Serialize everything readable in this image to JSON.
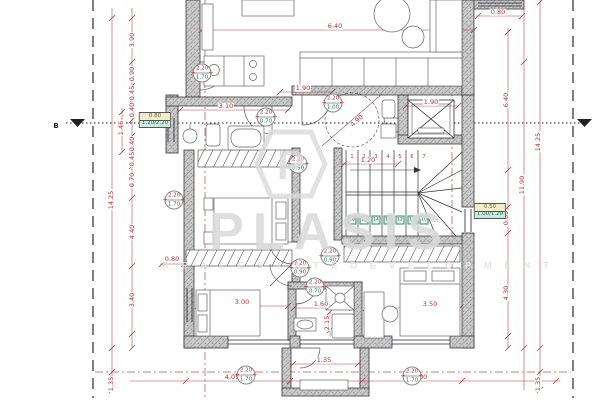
{
  "watermark": {
    "logo_letter": "P",
    "name": "PLASIS",
    "tagline": "R E A L   E S T A T E   D E V E L O P M E N T"
  },
  "section_mark": {
    "label": "B"
  },
  "colors": {
    "dimension_red": "#b03535",
    "axis_red": "#c04040",
    "wall_dark": "#3a3a3a",
    "tag_teal": "#1c7a5a",
    "tag_red": "#a33a3a",
    "watermark_gray": "#dadada"
  },
  "dimensions": [
    {
      "text": "3.90",
      "x": 132,
      "y": 40,
      "rot": -90
    },
    {
      "text": "0.90",
      "x": 132,
      "y": 74,
      "rot": -90
    },
    {
      "text": "0.45",
      "x": 132,
      "y": 93,
      "rot": -90
    },
    {
      "text": "0.40",
      "x": 132,
      "y": 110,
      "rot": -90
    },
    {
      "text": "1.46",
      "x": 121,
      "y": 128,
      "rot": -90
    },
    {
      "text": "0.40",
      "x": 132,
      "y": 144,
      "rot": -90
    },
    {
      "text": "0.45",
      "x": 132,
      "y": 159,
      "rot": -90
    },
    {
      "text": "0.70",
      "x": 132,
      "y": 180,
      "rot": -90
    },
    {
      "text": "4.40",
      "x": 132,
      "y": 232,
      "rot": -90
    },
    {
      "text": "3.40",
      "x": 132,
      "y": 300,
      "rot": -90
    },
    {
      "text": "14.25",
      "x": 111,
      "y": 200,
      "rot": -90
    },
    {
      "text": "1.35",
      "x": 111,
      "y": 384,
      "rot": -90
    },
    {
      "text": "6.40",
      "x": 335,
      "y": 26,
      "rot": 0
    },
    {
      "text": "0.80",
      "x": 498,
      "y": 12,
      "rot": 0
    },
    {
      "text": "6.40",
      "x": 506,
      "y": 100,
      "rot": -90
    },
    {
      "text": "0.80",
      "x": 506,
      "y": 218,
      "rot": -90
    },
    {
      "text": "4.30",
      "x": 506,
      "y": 293,
      "rot": -90
    },
    {
      "text": "11.90",
      "x": 522,
      "y": 185,
      "rot": -90
    },
    {
      "text": "14.25",
      "x": 538,
      "y": 142,
      "rot": -90
    },
    {
      "text": "1.35",
      "x": 538,
      "y": 384,
      "rot": -90
    },
    {
      "text": "3.10",
      "x": 226,
      "y": 106,
      "rot": 0
    },
    {
      "text": "1.90",
      "x": 303,
      "y": 88,
      "rot": 0
    },
    {
      "text": "1.90",
      "x": 431,
      "y": 102,
      "rot": 0
    },
    {
      "text": "4.90",
      "x": 357,
      "y": 121,
      "rot": -42
    },
    {
      "text": "1.20",
      "x": 368,
      "y": 160,
      "rot": 0
    },
    {
      "text": "0.80",
      "x": 172,
      "y": 259,
      "rot": 0
    },
    {
      "text": "3.00",
      "x": 242,
      "y": 302,
      "rot": 0
    },
    {
      "text": "1.60",
      "x": 321,
      "y": 304,
      "rot": 0
    },
    {
      "text": "3.50",
      "x": 430,
      "y": 304,
      "rot": 0
    },
    {
      "text": "2.15",
      "x": 327,
      "y": 323,
      "rot": -90
    },
    {
      "text": "1.35",
      "x": 324,
      "y": 360,
      "rot": 0
    },
    {
      "text": "4.05",
      "x": 232,
      "y": 377,
      "rot": 0
    },
    {
      "text": "5.00",
      "x": 420,
      "y": 377,
      "rot": 0
    }
  ],
  "door_tags": [
    {
      "x": 202,
      "y": 73,
      "top": "2.20",
      "bottom": "1.70"
    },
    {
      "x": 266,
      "y": 117,
      "top": "2.20",
      "bottom": "0.70"
    },
    {
      "x": 333,
      "y": 103,
      "top": "2.20",
      "bottom": "1.00"
    },
    {
      "x": 298,
      "y": 164,
      "top": "2.20",
      "bottom": "0.90"
    },
    {
      "x": 174,
      "y": 200,
      "top": "2.20",
      "bottom": "1.70"
    },
    {
      "x": 330,
      "y": 256,
      "top": "2.20",
      "bottom": "0.90"
    },
    {
      "x": 300,
      "y": 268,
      "top": "2.20",
      "bottom": "0.90"
    },
    {
      "x": 315,
      "y": 287,
      "top": "2.20",
      "bottom": "0.70"
    },
    {
      "x": 246,
      "y": 375,
      "top": "2.20",
      "bottom": "1.70"
    },
    {
      "x": 412,
      "y": 376,
      "top": "2.20",
      "bottom": "1.70"
    }
  ],
  "window_tags": [
    {
      "x": 155,
      "y": 112,
      "top": "0.80",
      "bottom": "1.20/2.20"
    },
    {
      "x": 490,
      "y": 203,
      "top": "0.50",
      "bottom": "1.00/1.20"
    }
  ],
  "stairs": {
    "up_numbers": [
      "1",
      "2",
      "3",
      "4",
      "5",
      "6",
      "7"
    ],
    "down_numbers": [
      "16",
      "15",
      "14",
      "13",
      "12",
      "11",
      "10"
    ]
  }
}
